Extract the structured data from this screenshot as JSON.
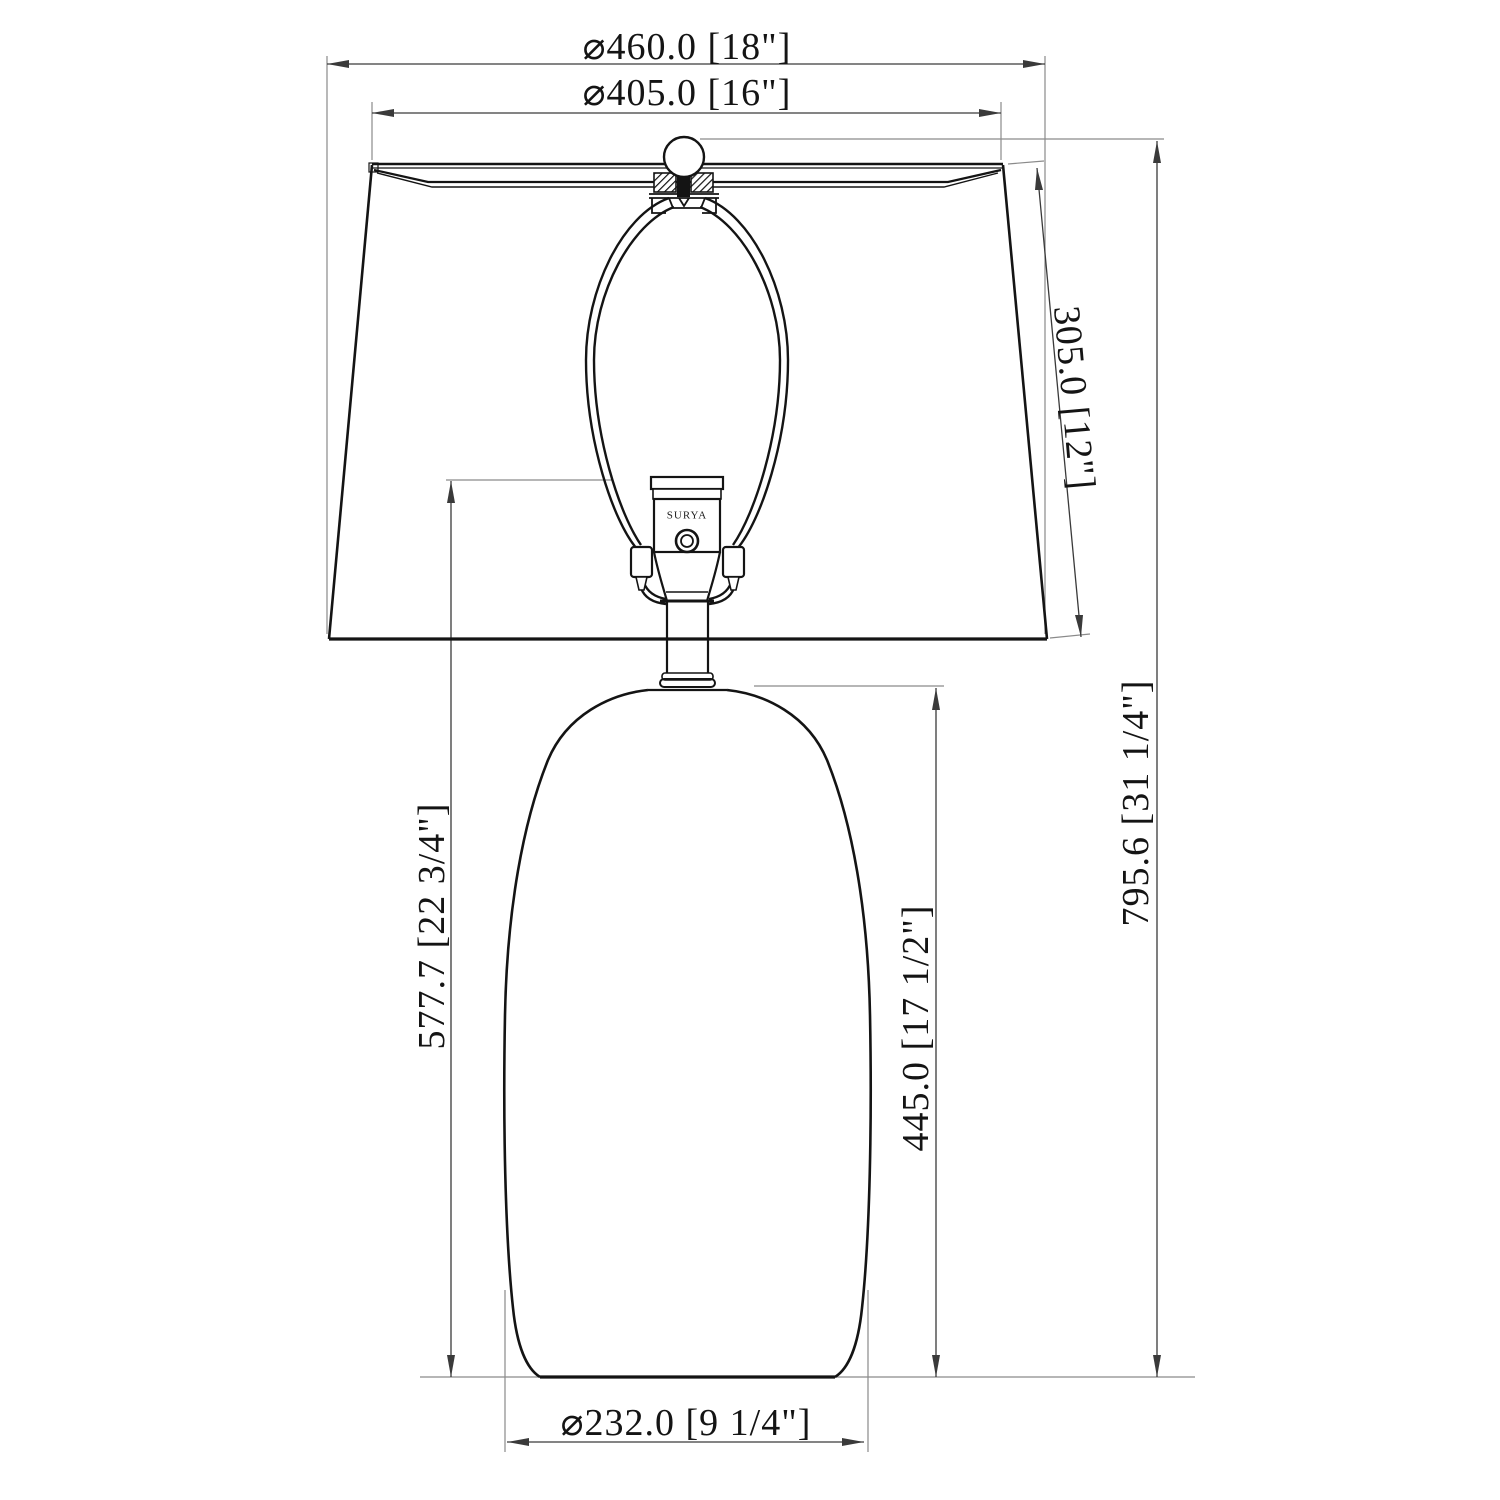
{
  "page": {
    "background": "#ffffff",
    "line_color": "#141414",
    "extension_line_color": "#8a8a8a",
    "dimension_line_color": "#3a3a3a"
  },
  "drawing": {
    "type": "table-lamp-dimension-drawing",
    "brand_label": "SURYA",
    "dimensions": {
      "shade_bottom_diameter": "⌀460.0 [18\"]",
      "shade_top_diameter": "⌀405.0 [16\"]",
      "shade_slant_height": "305.0 [12\"]",
      "overall_height": "795.6 [31 1/4\"]",
      "base_top_height": "577.7 [22 3/4\"]",
      "body_height": "445.0 [17 1/2\"]",
      "base_diameter": "⌀232.0 [9 1/4\"]"
    }
  }
}
